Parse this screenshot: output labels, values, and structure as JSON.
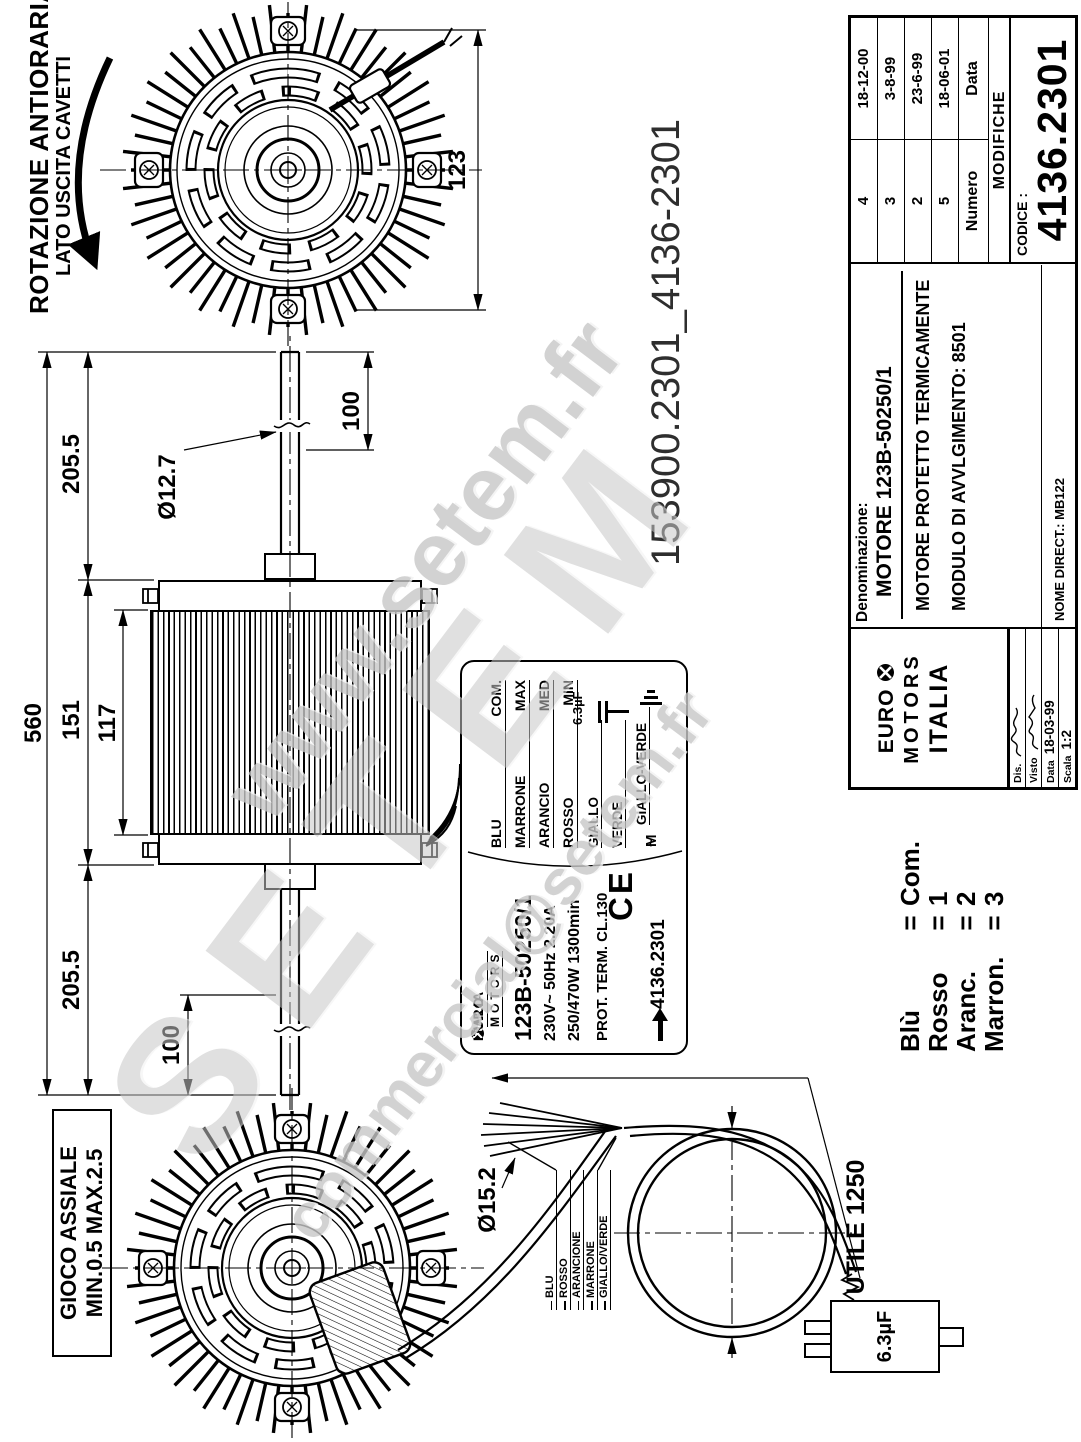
{
  "watermark": {
    "line1": "www.setem.fr",
    "line2": "SETEM",
    "line3": "commercial@setem.fr"
  },
  "file_ref": "153900.2301_4136-2301",
  "rotation_note": {
    "line1": "ROTAZIONE ANTIORARIA",
    "line2": "LATO USCITA CAVETTI"
  },
  "axial_play": {
    "line1": "GIOCO ASSIALE",
    "line2": "MIN.0.5 MAX.2.5"
  },
  "dimensions": {
    "overall": "560",
    "shaft_right": "205.5",
    "body": "151",
    "stack": "117",
    "shaft_left": "205.5",
    "shaft_end_right": "100",
    "shaft_end_left": "100",
    "shaft_dia": "Ø12.7",
    "fan_width": "123",
    "cable_dia": "Ø15.2",
    "cable_length": "UTILE 1250",
    "capacitor": "6.3µF"
  },
  "nameplate": {
    "brand_euro": "EURO",
    "brand_italia": "ITALIA",
    "brand_motors": "MOTORS",
    "model": "123B-50250/1",
    "electrical": "230V~  50Hz  2.20A",
    "power": "250/470W  1300min",
    "protection": "PROT. TERM.   CL.130",
    "code": "4136.2301",
    "ce_mark": "CE",
    "motor_m": "M",
    "motor_tilde": "~",
    "wires": [
      {
        "color": "BLU",
        "role": "COM."
      },
      {
        "color": "MARRONE",
        "role": "MAX"
      },
      {
        "color": "ARANCIO",
        "role": "MED"
      },
      {
        "color": "ROSSO",
        "role": "MIN"
      }
    ],
    "wire_giallo": "GIALLO",
    "cap_value": "6.3µF",
    "wire_verde": "VERDE",
    "wire_giallo_verde": "GIALLO-VERDE"
  },
  "wiring": {
    "colors": [
      "BLU",
      "ROSSO",
      "ARANCIONE",
      "MARRONE",
      "GIALLO/VERDE"
    ],
    "eq_sign": "=",
    "legend": [
      {
        "name": "Blù",
        "value": "Com."
      },
      {
        "name": "Rosso",
        "value": "1"
      },
      {
        "name": "Aranc.",
        "value": "2"
      },
      {
        "name": "Marron.",
        "value": "3"
      }
    ]
  },
  "titleblock": {
    "revisions": [
      {
        "numero": "4",
        "data": "18-12-00"
      },
      {
        "numero": "3",
        "data": "3-8-99"
      },
      {
        "numero": "2",
        "data": "23-6-99"
      },
      {
        "numero": "5",
        "data": "18-06-01"
      }
    ],
    "numero_label": "Numero",
    "data_col_label": "Data",
    "modifiche": "MODIFICHE",
    "codice_label": "CODICE :",
    "codice": "4136.2301",
    "denominazione_label": "Denominazione:",
    "den_line1": "MOTORE 123B-50250/1",
    "den_line2": "MOTORE  PROTETTO TERMICAMENTE",
    "den_line3": "MODULO  DI  AVVLGIMENTO: 8501",
    "nome_direct": "NOME DIRECT.: MB122",
    "brand_euro": "EURO",
    "brand_motors": "MOTORS",
    "brand_italia": "ITALIA",
    "dis_label": "Dis.",
    "visto_label": "Visto",
    "data_field_label": "Data",
    "data_value": "18-03-99",
    "scala_label": "Scala",
    "scala_value": "1:2"
  }
}
